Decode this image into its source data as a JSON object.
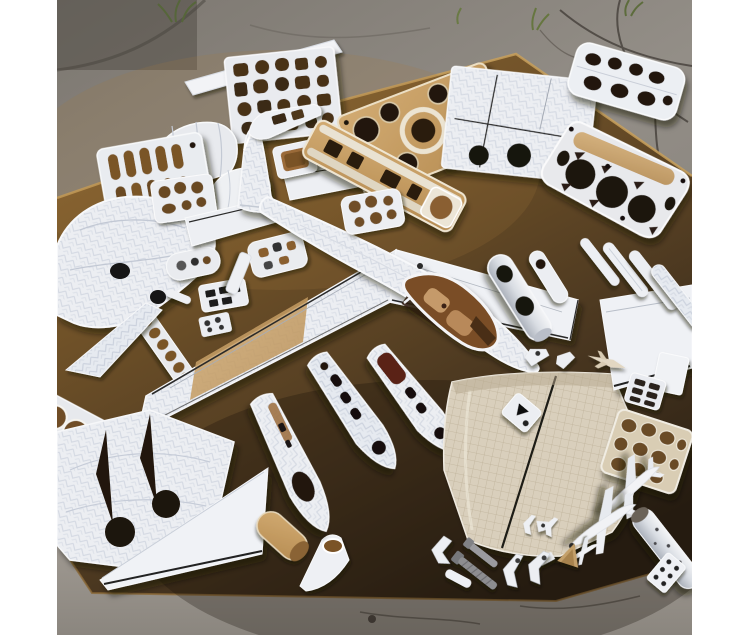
{
  "meta": {
    "type": "photograph",
    "description": "Overhead flat-lay (knolling) photo of a disassembled white model airplane: a partly assembled light aircraft with long straight wing and swept tail sits in the middle of a large brown fiberboard mat laid on cracked concrete pavement, surrounded by neatly arranged parts: laser-cut rib and former sheets with round and square cutouts, plywood frames, fuselage half-shells with window openings, wing skins, engine cowls, canopy domes, lattice spar trusses, small jet models, tubes, bolts and brackets. White margins border the left and right edges of the square photo."
  },
  "scene": {
    "setting": "cracked gray concrete pavement with small weeds",
    "surface": "large brown fiberboard / cutting mat, lit from upper left, darkening toward the bottom",
    "subject": "white model airplane disassembled into parts, knolling arrangement",
    "parts": [
      {
        "name": "main-airplane",
        "desc": "assembled white plane: swept vertical fin, two tailplanes, long diagonal wing with tan root band, fuselage with open cockpit showing tan leather seats, nose pointing lower-right"
      },
      {
        "name": "edge-strip",
        "desc": "long white balsa strip along the upper-left board edge"
      },
      {
        "name": "former-grid-sheet",
        "desc": "white sheet with grid of square/round brown cutouts, top left"
      },
      {
        "name": "plywood-former-sheet",
        "desc": "tan plywood sheet with large round holes and white ring, top center"
      },
      {
        "name": "wing-panel-top",
        "desc": "white wing panel with black panel lines and two black circular holes, top right of center"
      },
      {
        "name": "lattice-truss-small",
        "desc": "small white lattice sheet with dark cells, top right corner"
      },
      {
        "name": "lattice-truss-large",
        "desc": "large white spar truss with three big dark circular holes and tan insert, right side"
      },
      {
        "name": "cowl-dome-large",
        "desc": "white curved cowl dome, upper left"
      },
      {
        "name": "cowl-dome-small",
        "desc": "smaller white dome shell"
      },
      {
        "name": "slot-sheet",
        "desc": "white rib sheet with columns of tan slots, left"
      },
      {
        "name": "fuselage-shell-left",
        "desc": "large white fuselage shell with two black holes, left edge"
      },
      {
        "name": "rib-plate-a",
        "desc": "small white plate with tan holes"
      },
      {
        "name": "canopy-plate",
        "desc": "small white plate with tan cutouts below the tail"
      },
      {
        "name": "windshield-wedge",
        "desc": "small white windshield bracket"
      },
      {
        "name": "cube-box",
        "desc": "small open white box with tan interior"
      },
      {
        "name": "crutch-ladder",
        "desc": "tan ladder-like fuselage crutch with white rails, upper middle"
      },
      {
        "name": "former-plate-mid",
        "desc": "white former plate with six tan holes, center"
      },
      {
        "name": "oval-plate",
        "desc": "small oval access plate with dark spots"
      },
      {
        "name": "panel-plate",
        "desc": "instrument-panel plate with dark rectangular cutouts"
      },
      {
        "name": "mini-plate-dots",
        "desc": "tiny plate with dark holes"
      },
      {
        "name": "strip-small",
        "desc": "short white strip"
      },
      {
        "name": "mini-blade",
        "desc": "tiny white blade"
      },
      {
        "name": "rib-ladder-left",
        "desc": "ladder strip with oval tan holes, mid left"
      },
      {
        "name": "blade-left",
        "desc": "tapered white blade, mid left"
      },
      {
        "name": "hole-sheet-left",
        "desc": "white sheet with big tan circles, lower left"
      },
      {
        "name": "wing-skin-cutouts",
        "desc": "folded white wing skins with two triangular cutouts and two black holes, bottom left"
      },
      {
        "name": "delta-wing-panel",
        "desc": "white triangular wing panel with black trailing-edge line, bottom left"
      },
      {
        "name": "cowl-tube-right",
        "desc": "white tube shells with black round openings, right of the nose"
      },
      {
        "name": "fuselage-half-shell-a",
        "desc": "fuselage half-shell with large dark oval opening, bottom center"
      },
      {
        "name": "fuselage-half-shell-b",
        "desc": "fuselage half-shell with window cutouts"
      },
      {
        "name": "fuselage-half-shell-c",
        "desc": "fuselage half-shell with windows and dark red interior"
      },
      {
        "name": "quilted-panel",
        "desc": "large beige quilted skin panel with dark center seam, bottom center-right"
      },
      {
        "name": "honeycomb-sheet",
        "desc": "tan honeycomb core sheet with white frame, right"
      },
      {
        "name": "wing-panel-right",
        "desc": "white wing panel with black edge line, right edge"
      },
      {
        "name": "blade-fairings-right",
        "desc": "row of small white blade fairings, right middle"
      },
      {
        "name": "clip-parts",
        "desc": "small white clips above the quilted panel"
      },
      {
        "name": "grid-rack",
        "desc": "tiny white rack with dark slots"
      },
      {
        "name": "rect-sheet-small",
        "desc": "small white rectangular sheet"
      },
      {
        "name": "marked-plate",
        "desc": "small white plate with black triangle markings"
      },
      {
        "name": "jet-model-1",
        "desc": "small swept-wing jet model, nose down-left"
      },
      {
        "name": "jet-model-2",
        "desc": "second small jet model"
      },
      {
        "name": "jet-model-3",
        "desc": "tiny jet/bird-shaped part"
      },
      {
        "name": "tube-cylinder",
        "desc": "white cylinder with dark end cap, bottom right"
      },
      {
        "name": "fastener-plate",
        "desc": "small plate with fastener dots, bottom right corner"
      },
      {
        "name": "bolts",
        "desc": "two gray threaded bolts"
      },
      {
        "name": "angle-brackets",
        "desc": "small white angle brackets"
      },
      {
        "name": "gear-legs",
        "desc": "small white landing-gear legs"
      },
      {
        "name": "tan-wedge",
        "desc": "small tan wedge"
      },
      {
        "name": "cone-funnel",
        "desc": "white funnel shell and rolled tan tube, bottom center-left"
      }
    ],
    "palette": {
      "margin_white": "#ffffff",
      "concrete_light": "#938e87",
      "concrete_dark": "#6e6962",
      "crack": "#3f3a34",
      "weed_green": "#56663a",
      "board_light": "#8a6532",
      "board_mid": "#5c4423",
      "board_dark": "#2c2114",
      "board_rim": "#c8a05c",
      "part_white": "#eef0f4",
      "part_shadow": "#9aa0ac",
      "herringbone": "#d3d8e2",
      "plywood_tan": "#c49e66",
      "hole_dark": "#241810",
      "hole_tan": "#6f4e26",
      "cockpit_tan": "#7a4e26",
      "seat_leather": "#c59a6b",
      "quilt_beige": "#d9cfbc",
      "line_black": "#222222",
      "metal_gray": "#8d8d90"
    }
  }
}
